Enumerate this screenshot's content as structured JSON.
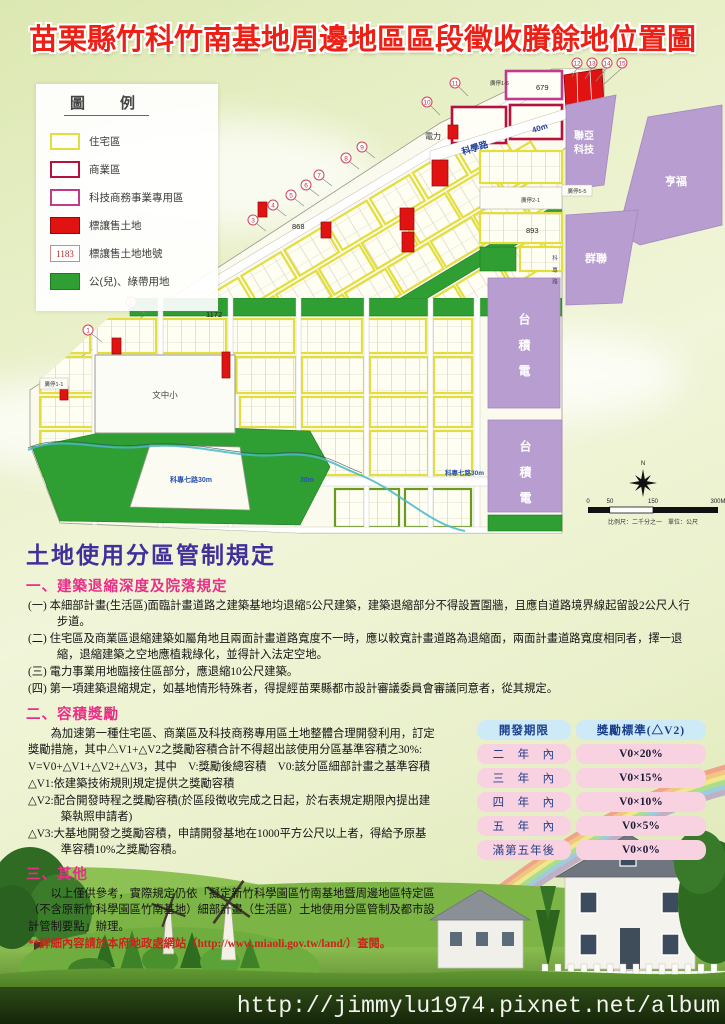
{
  "title": "苗栗縣竹科竹南基地周邊地區區段徵收賸餘地位置圖",
  "legend": {
    "title": "圖　例",
    "items": [
      {
        "label": "住宅區",
        "type": "residential",
        "color": "#e3de3d"
      },
      {
        "label": "商業區",
        "type": "commercial",
        "color": "#b5123f"
      },
      {
        "label": "科技商務事業專用區",
        "type": "tech-business",
        "color": "#c23a8c"
      },
      {
        "label": "標讓售土地",
        "type": "land-for-sale",
        "color": "#e01212"
      },
      {
        "label": "標讓售土地地號",
        "type": "parcel-number",
        "sample": "1183"
      },
      {
        "label": "公(兒)、綠帶用地",
        "type": "park-greenbelt",
        "color": "#2f9e33"
      }
    ]
  },
  "map": {
    "companies": {
      "lianya1": "聯亞",
      "lianya2": "科技",
      "hengfu": "亨福",
      "qunlian": "群聯",
      "tsmc": "台積電"
    },
    "roads": {
      "science": "科學路",
      "science_w": "40m",
      "kezhuan7": "科專七路30m",
      "w30": "30m",
      "kezhuan7b": "科專七路30m",
      "kezhuan": "科專路"
    },
    "labels": {
      "power": "電力",
      "school": "文中小",
      "p11": "廣停1-1",
      "p16": "廣停1-6",
      "p21": "廣停2-1",
      "p55": "廣停5-5"
    },
    "parcels": {
      "a": "679",
      "b": "868",
      "c": "1172",
      "d": "893"
    },
    "markers": [
      "1",
      "2",
      "3",
      "4",
      "5",
      "6",
      "7",
      "8",
      "9",
      "10",
      "11",
      "12",
      "13",
      "14",
      "15"
    ],
    "compass_n": "N",
    "scalebar": {
      "t0": "0",
      "t50": "50",
      "t150": "150",
      "t300": "300M",
      "caption": "比例尺：二千分之一　單位：公尺"
    }
  },
  "regulations": {
    "title": "土地使用分區管制規定",
    "s1": {
      "heading": "一、建築退縮深度及院落規定",
      "items": [
        "(一) 本細部計畫(生活區)面臨計畫道路之建築基地均退縮5公尺建築，建築退縮部分不得設置圍牆，且應自道路境界線起留設2公尺人行步道。",
        "(二) 住宅區及商業區退縮建築如屬角地且兩面計畫道路寬度不一時，應以較寬計畫道路為退縮面，兩面計畫道路寬度相同者，擇一退縮，退縮建築之空地應植栽綠化，並得計入法定空地。",
        "(三) 電力事業用地臨接住區部分，應退縮10公尺建築。",
        "(四) 第一項建築退縮規定，如基地情形特殊者，得提經苗栗縣都市設計審議委員會審議同意者，從其規定。"
      ]
    },
    "s2": {
      "heading": "二、容積獎勵",
      "p1": "為加速第一種住宅區、商業區及科技商務專用區土地整體合理開發利用，訂定獎勵措施，其中△V1+△V2之獎勵容積合計不得超出該使用分區基準容積之30%:",
      "p2": "V=V0+△V1+△V2+△V3，其中　V:獎勵後總容積　V0:該分區細部計畫之基準容積",
      "p3": "△V1:依建築技術規則規定提供之獎勵容積",
      "p4": "△V2:配合開發時程之獎勵容積(於區段徵收完成之日起，於右表規定期限內提出建築執照申請者)",
      "p5": "△V3:大基地開發之獎勵容積，申請開發基地在1000平方公尺以上者，得給予原基準容積10%之獎勵容積。"
    },
    "s3": {
      "heading": "三、其他",
      "body": "以上僅供參考，實際規定仍依「擬定新竹科學園區竹南基地暨周邊地區特定區（不含原新竹科學園區竹南基地）細部計畫（生活區）土地使用分區管制及都市設計管制要點」辦理。",
      "note": "**詳細內容請於本府地政處網站（http://www.miaoli.gov.tw/land/）查閱。"
    }
  },
  "table": {
    "headers": [
      "開發期限",
      "獎勵標準(△V2)"
    ],
    "rows": [
      {
        "term": "二　年　內",
        "value": "V0×20%"
      },
      {
        "term": "三　年　內",
        "value": "V0×15%"
      },
      {
        "term": "四　年　內",
        "value": "V0×10%"
      },
      {
        "term": "五　年　內",
        "value": "V0×5%"
      },
      {
        "term": "滿第五年後",
        "value": "V0×0%"
      }
    ]
  },
  "watermark": "http://jimmylu1974.pixnet.net/album",
  "colors": {
    "title_red": "#ed2016",
    "heading_purple": "#41309c",
    "heading_pink": "#e82f86",
    "note_red": "#c9251c",
    "residential_yellow": "#e3de3d",
    "commercial_crimson": "#b5123f",
    "tech_magenta": "#c23a8c",
    "sale_red": "#e01212",
    "park_green": "#2f9e33",
    "company_purple": "#b79dd0",
    "table_header_blue": "#cdeaf6",
    "table_row_pink": "#f8d2e0"
  }
}
